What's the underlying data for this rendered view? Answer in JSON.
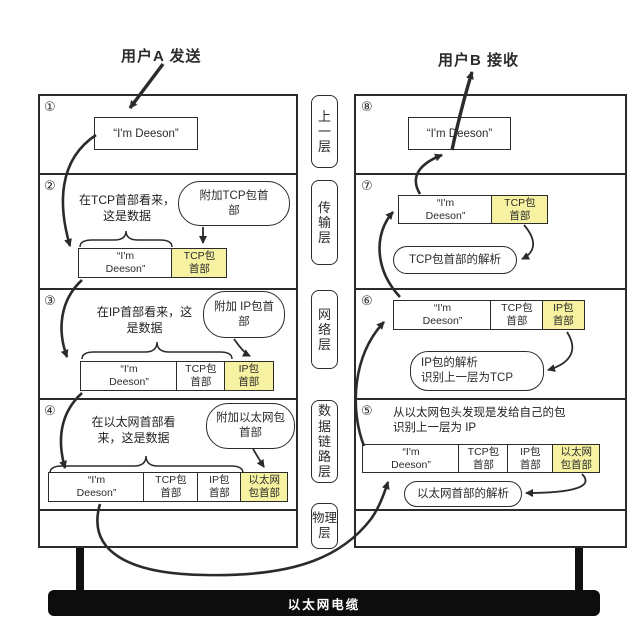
{
  "titles": {
    "sender": "用户A 发送",
    "receiver": "用户B 接收"
  },
  "layers": {
    "upper": "上一层",
    "transport": "传输层",
    "network": "网络层",
    "datalink": "数据链路层",
    "physical": "物理层"
  },
  "cable": {
    "label": "以太网电缆"
  },
  "colors": {
    "highlight": "#f7f2a1",
    "line": "#2b2b2b"
  },
  "message": "“I'm Deeson”",
  "message_wrapped": "“I'm\nDeeson”",
  "headers": {
    "tcp": "TCP包\n首部",
    "ip": "IP包\n首部",
    "eth": "以太网\n包首部"
  },
  "left": {
    "s1": {
      "num": "①"
    },
    "s2": {
      "num": "②",
      "note": "在TCP首部看来，\n这是数据",
      "callout": "附加TCP包首\n部"
    },
    "s3": {
      "num": "③",
      "note": "在IP首部看来，这\n是数据",
      "callout": "附加 IP包首\n部"
    },
    "s4": {
      "num": "④",
      "note": "在以太网首部看\n来，这是数据",
      "callout": "附加以太网包\n首部"
    }
  },
  "right": {
    "s8": {
      "num": "⑧"
    },
    "s7": {
      "num": "⑦",
      "callout": "TCP包首部的解析"
    },
    "s6": {
      "num": "⑥",
      "callout": "IP包的解析\n识别上一层为TCP"
    },
    "s5": {
      "num": "⑤",
      "note": "从以太网包头发现是发给自己的包\n识别上一层为 IP",
      "callout": "以太网首部的解析"
    }
  }
}
